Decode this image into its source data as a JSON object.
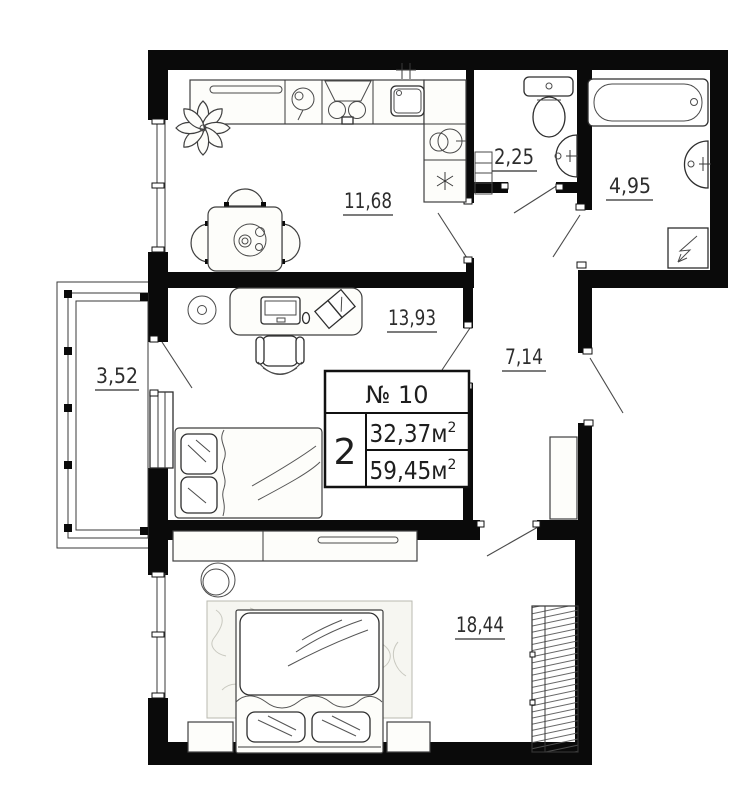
{
  "colors": {
    "wall": "#0a0a0a",
    "background": "#ffffff",
    "line": "#3f3f3f"
  },
  "unit_info": {
    "number": "№ 10",
    "rooms_count": "2",
    "living_area": "32,37м",
    "total_area": "59,45м",
    "area_superscript": "2"
  },
  "room_labels": {
    "kitchen": "11,68",
    "toilet": "2,25",
    "bathroom": "4,95",
    "living_room": "13,93",
    "hallway": "7,14",
    "balcony": "3,52",
    "bedroom": "18,44"
  }
}
